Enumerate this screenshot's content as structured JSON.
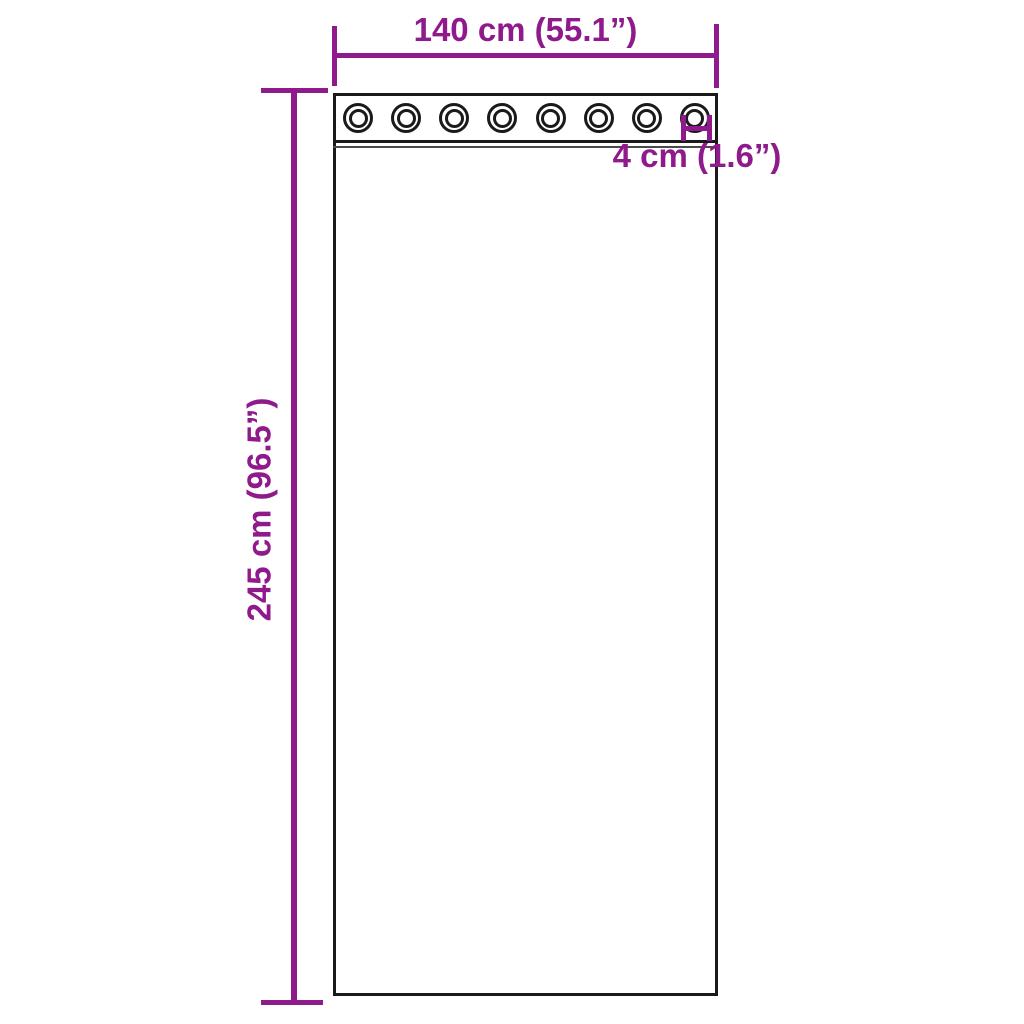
{
  "diagram": {
    "type": "product-dimension-diagram",
    "subject": "curtain-panel-with-grommets",
    "colors": {
      "accent": "#8e1a8c",
      "outline": "#1a1a1a",
      "background": "#ffffff"
    },
    "dimensions": {
      "width_label": "140 cm (55.1”)",
      "height_label": "245 cm (96.5”)",
      "grommet_label": "4 cm (1.6”)"
    },
    "grommets": {
      "count": 8
    }
  }
}
